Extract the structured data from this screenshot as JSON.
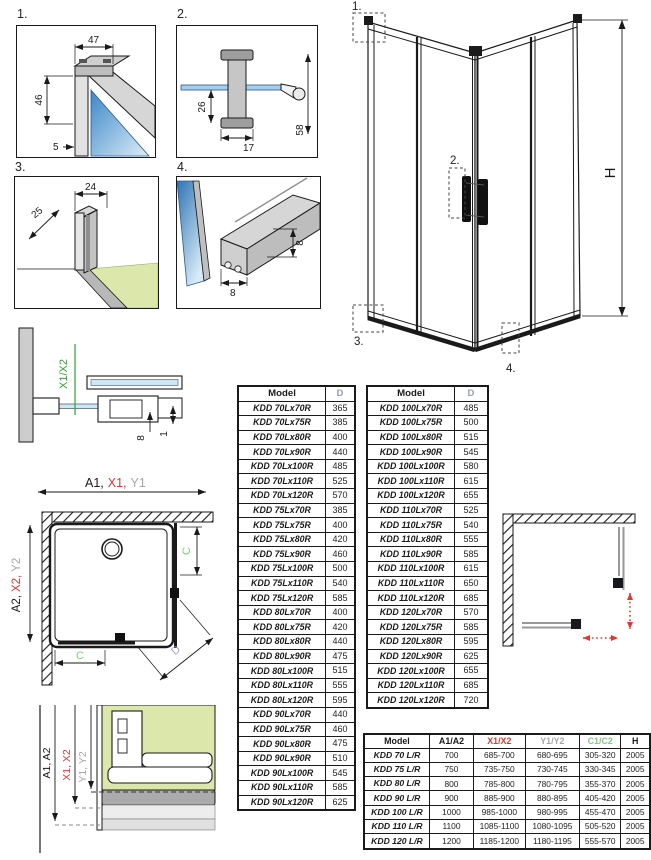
{
  "colors": {
    "ink": "#1a1a1a",
    "red": "#d23b35",
    "gray": "#a7a7a7",
    "green": "#85c785",
    "axis_green": "#2e9e36",
    "purple": "#b29fd0",
    "glass_blue": "#5d9bd0",
    "floor_green": "#dce7ab",
    "arrow_red": "#e2382c"
  },
  "detail_panels": {
    "p1": {
      "label": "1.",
      "dim_top": "47",
      "dim_left": "46",
      "dim_bottom": "5"
    },
    "p2": {
      "label": "2.",
      "dim_left": "26",
      "dim_bottom": "17",
      "dim_right": "58"
    },
    "p3": {
      "label": "3.",
      "dim_diag": "25",
      "dim_top": "24"
    },
    "p4": {
      "label": "4.",
      "dim_right": "8",
      "dim_bottom": "8"
    }
  },
  "assembly": {
    "callout_1": "1.",
    "callout_2": "2.",
    "callout_3": "3.",
    "callout_4": "4.",
    "height_label": "H"
  },
  "section_detail": {
    "axis_label": "X1/X2",
    "dim_8": "8",
    "dim_1": "1",
    "span_a": "A1,",
    "span_x": "X1,",
    "span_y": "Y1"
  },
  "plan_view": {
    "span_a": "A2,",
    "span_x": "X2,",
    "span_y": "Y2",
    "c_right": "C",
    "c_bottom": "C",
    "d_label": "D"
  },
  "wall_section": {
    "label_a": "A1, A2",
    "label_x": "X1, X2",
    "label_y": "Y1, Y2"
  },
  "table_left": {
    "col_model": "Model",
    "col_d": "D",
    "rows": [
      [
        "KDD 70Lx70R",
        "365"
      ],
      [
        "KDD 70Lx75R",
        "385"
      ],
      [
        "KDD 70Lx80R",
        "400"
      ],
      [
        "KDD 70Lx90R",
        "440"
      ],
      [
        "KDD 70Lx100R",
        "485"
      ],
      [
        "KDD 70Lx110R",
        "525"
      ],
      [
        "KDD 70Lx120R",
        "570"
      ],
      [
        "KDD 75Lx70R",
        "385"
      ],
      [
        "KDD 75Lx75R",
        "400"
      ],
      [
        "KDD 75Lx80R",
        "420"
      ],
      [
        "KDD 75Lx90R",
        "460"
      ],
      [
        "KDD 75Lx100R",
        "500"
      ],
      [
        "KDD 75Lx110R",
        "540"
      ],
      [
        "KDD 75Lx120R",
        "585"
      ],
      [
        "KDD 80Lx70R",
        "400"
      ],
      [
        "KDD 80Lx75R",
        "420"
      ],
      [
        "KDD 80Lx80R",
        "440"
      ],
      [
        "KDD 80Lx90R",
        "475"
      ],
      [
        "KDD 80Lx100R",
        "515"
      ],
      [
        "KDD 80Lx110R",
        "555"
      ],
      [
        "KDD 80Lx120R",
        "595"
      ],
      [
        "KDD 90Lx70R",
        "440"
      ],
      [
        "KDD 90Lx75R",
        "460"
      ],
      [
        "KDD 90Lx80R",
        "475"
      ],
      [
        "KDD 90Lx90R",
        "510"
      ],
      [
        "KDD 90Lx100R",
        "545"
      ],
      [
        "KDD 90Lx110R",
        "585"
      ],
      [
        "KDD 90Lx120R",
        "625"
      ]
    ]
  },
  "table_right": {
    "col_model": "Model",
    "col_d": "D",
    "rows": [
      [
        "KDD 100Lx70R",
        "485"
      ],
      [
        "KDD 100Lx75R",
        "500"
      ],
      [
        "KDD 100Lx80R",
        "515"
      ],
      [
        "KDD 100Lx90R",
        "545"
      ],
      [
        "KDD 100Lx100R",
        "580"
      ],
      [
        "KDD 100Lx110R",
        "615"
      ],
      [
        "KDD 100Lx120R",
        "655"
      ],
      [
        "KDD 110Lx70R",
        "525"
      ],
      [
        "KDD 110Lx75R",
        "540"
      ],
      [
        "KDD 110Lx80R",
        "555"
      ],
      [
        "KDD 110Lx90R",
        "585"
      ],
      [
        "KDD 110Lx100R",
        "615"
      ],
      [
        "KDD 110Lx110R",
        "650"
      ],
      [
        "KDD 110Lx120R",
        "685"
      ],
      [
        "KDD 120Lx70R",
        "570"
      ],
      [
        "KDD 120Lx75R",
        "585"
      ],
      [
        "KDD 120Lx80R",
        "595"
      ],
      [
        "KDD 120Lx90R",
        "625"
      ],
      [
        "KDD 120Lx100R",
        "655"
      ],
      [
        "KDD 120Lx110R",
        "685"
      ],
      [
        "KDD 120Lx120R",
        "720"
      ]
    ]
  },
  "spec_table": {
    "columns": [
      "Model",
      "A1/A2",
      "X1/X2",
      "Y1/Y2",
      "C1/C2",
      "H"
    ],
    "rows": [
      [
        "KDD 70 L/R",
        "700",
        "685-700",
        "680-695",
        "305-320",
        "2005"
      ],
      [
        "KDD 75 L/R",
        "750",
        "735-750",
        "730-745",
        "330-345",
        "2005"
      ],
      [
        "KDD 80 L/R",
        "800",
        "785-800",
        "780-795",
        "355-370",
        "2005"
      ],
      [
        "KDD 90 L/R",
        "900",
        "885-900",
        "880-895",
        "405-420",
        "2005"
      ],
      [
        "KDD 100 L/R",
        "1000",
        "985-1000",
        "980-995",
        "455-470",
        "2005"
      ],
      [
        "KDD 110 L/R",
        "1100",
        "1085-1100",
        "1080-1095",
        "505-520",
        "2005"
      ],
      [
        "KDD 120 L/R",
        "1200",
        "1185-1200",
        "1180-1195",
        "555-570",
        "2005"
      ]
    ]
  }
}
